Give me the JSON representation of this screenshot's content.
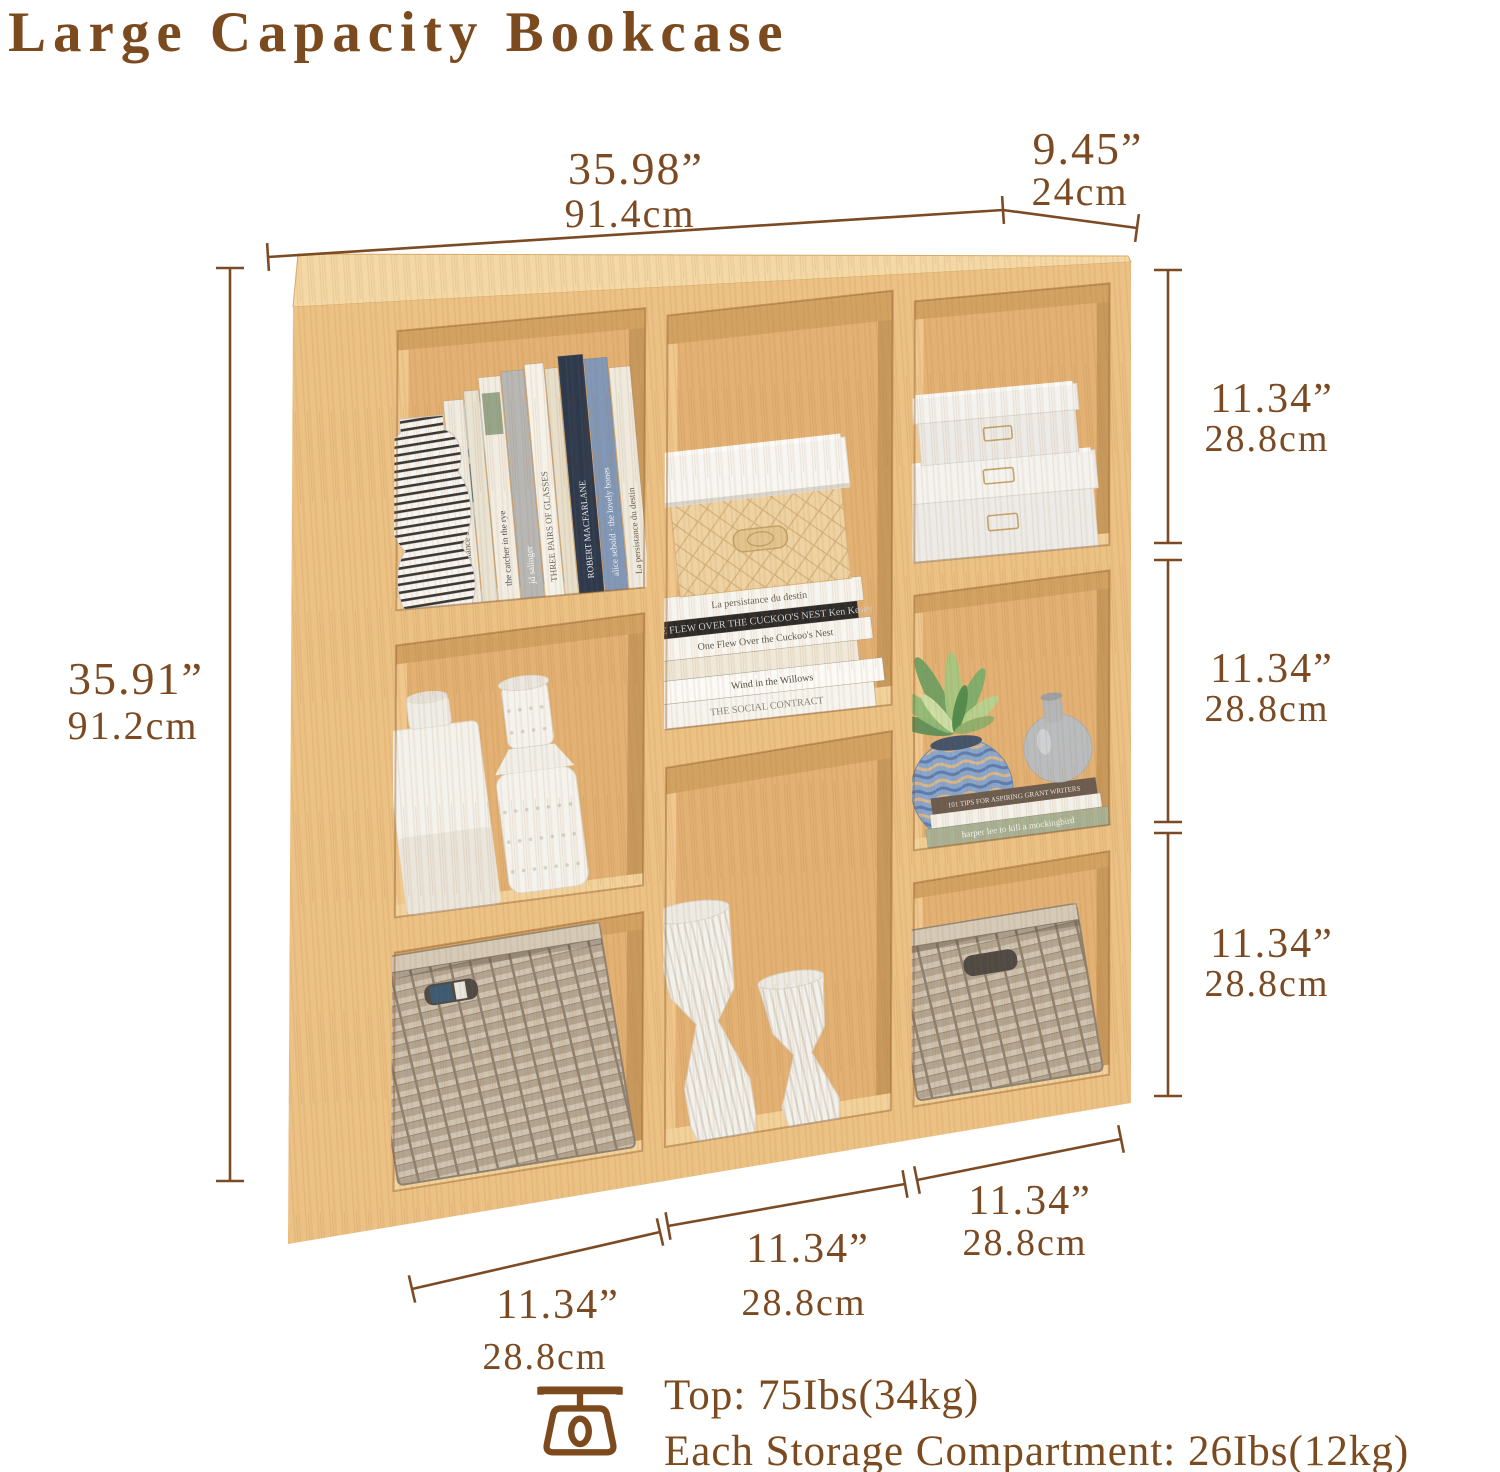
{
  "title": "Large Capacity Bookcase",
  "colors": {
    "accent_brown": "#7b4a1e",
    "dim_line": "#7c4b24",
    "wood_front": "#ecc184",
    "wood_top": "#f4d9a6",
    "wood_interior": "#e2b173",
    "wood_interior_shadow": "#c8995d",
    "wood_interior_light": "#f0c78d",
    "wood_interior_top": "#d2a263",
    "wood_floor": "#f2d29a",
    "gold": "#c2a368"
  },
  "dims": {
    "width": {
      "in": "35.98”",
      "cm": "91.4cm"
    },
    "depth": {
      "in": "9.45”",
      "cm": "24cm"
    },
    "height": {
      "in": "35.91”",
      "cm": "91.2cm"
    },
    "right": [
      {
        "in": "11.34”",
        "cm": "28.8cm"
      },
      {
        "in": "11.34”",
        "cm": "28.8cm"
      },
      {
        "in": "11.34”",
        "cm": "28.8cm"
      }
    ],
    "bottom": [
      {
        "in": "11.34”",
        "cm": "28.8cm"
      },
      {
        "in": "11.34”",
        "cm": "28.8cm"
      },
      {
        "in": "11.34”",
        "cm": "28.8cm"
      }
    ]
  },
  "footer": {
    "icon": "scale-icon",
    "top_capacity": "Top: 75Ibs(34kg)",
    "compartment_capacity": "Each Storage Compartment: 26Ibs(12kg)"
  },
  "bookcase": {
    "cells": {
      "left_top": {
        "art_book": {
          "c": "#d9ddd3"
        },
        "books": [
          {
            "w": 20,
            "h": 204,
            "c": "#f0ece1",
            "title": "La persistance du destin",
            "tc": "#6b6353"
          },
          {
            "w": 15,
            "h": 212,
            "c": "#e9e3d3"
          },
          {
            "w": 22,
            "h": 224,
            "c": "#f2ede3",
            "title": "the catcher in the rye",
            "tc": "#53525e",
            "band": "#97a68b"
          },
          {
            "w": 23,
            "h": 228,
            "c": "#b7b7b5",
            "title": "jd salinger",
            "tc": "#ffffff"
          },
          {
            "w": 19,
            "h": 233,
            "c": "#f5f2ea",
            "title": "THREE PAIRS OF GLASSES",
            "tc": "#6d675b"
          },
          {
            "w": 13,
            "h": 227,
            "c": "#e7dfcb"
          },
          {
            "w": 25,
            "h": 238,
            "c": "#2d3a4e",
            "title": "ROBERT MACFARLANE",
            "tc": "#e8e8ea"
          },
          {
            "w": 23,
            "h": 233,
            "c": "#8198b8",
            "title": "alice sebold · the lovely bones",
            "tc": "#f2f4f7"
          },
          {
            "w": 21,
            "h": 222,
            "c": "#efeade",
            "title": "La persistance du destin",
            "tc": "#6b6353"
          }
        ],
        "vase": {
          "stripe_dark": "#3a3733",
          "stripe_light": "#f7f5f1"
        }
      },
      "middle_top": {
        "stack": [
          {
            "w": 218,
            "h": 25,
            "c": "#f6f4ee",
            "title": "THE SOCIAL CONTRACT",
            "tc": "#8a8478",
            "dx": -4
          },
          {
            "w": 224,
            "h": 23,
            "c": "#fbfaf6",
            "title": "Wind in the Willows",
            "tc": "#514c45",
            "dx": 4
          },
          {
            "w": 202,
            "h": 20,
            "c": "#f0e9da",
            "dx": -8
          },
          {
            "w": 214,
            "h": 22,
            "c": "#f8f6f0",
            "title": "One Flew Over the Cuckoo's Nest",
            "tc": "#5e594f",
            "dx": 2
          },
          {
            "w": 198,
            "h": 17,
            "c": "#2a2a2a",
            "title": "ONE FLEW OVER THE CUCKOO'S NEST  Ken Kesey",
            "tc": "#cfcfcf",
            "dx": -2
          },
          {
            "w": 208,
            "h": 24,
            "c": "#f7f5ef",
            "title": "La persistance du destin",
            "tc": "#6b6353",
            "dx": 0
          }
        ],
        "box": {
          "base": "#eed2a2",
          "lid": "#f7f6f2",
          "plate": "#e3c48e"
        }
      },
      "right_top": {
        "box_color": "#edebe7",
        "lid_color": "#f4f3ef"
      },
      "left_middle": {
        "vase_white": "#f4f2ec",
        "vase_dotted": "#f5f3ee"
      },
      "right_middle": {
        "stack": [
          {
            "w": 184,
            "h": 19,
            "c": "#a9b295",
            "title": "harper lee   to kill a mockingbird",
            "tc": "#f4f4ee",
            "fs": 9
          },
          {
            "w": 172,
            "h": 14,
            "c": "#f3f1ea"
          },
          {
            "w": 166,
            "h": 16,
            "c": "#6b5c50",
            "title": "101 TIPS FOR ASPIRING GRANT WRITERS",
            "tc": "#e9e6df",
            "fs": 7
          }
        ],
        "pot": {
          "base": "#8aa6cc",
          "wave1": "#d7b88c",
          "wave2": "#5c7db0"
        },
        "gourd_vase": "#babdbf",
        "leaves": [
          [
            -72,
            62,
            16,
            "#5d8f57"
          ],
          [
            -48,
            74,
            18,
            "#8fbc77"
          ],
          [
            -20,
            84,
            18,
            "#6f9f63"
          ],
          [
            5,
            80,
            17,
            "#a4c77f"
          ],
          [
            32,
            70,
            16,
            "#7bae6b"
          ],
          [
            58,
            56,
            15,
            "#b5d38f"
          ],
          [
            -34,
            50,
            12,
            "#cfe0a8"
          ],
          [
            20,
            48,
            12,
            "#4f8a4c"
          ],
          [
            78,
            42,
            12,
            "#8fae6b"
          ]
        ]
      },
      "middle_bottom": {
        "vase_fill": "#f3f1eb"
      },
      "left_bottom": {
        "basket": {
          "base": "#c6b9a6",
          "rim": "#d5c9b7",
          "dark": "#4f4a43",
          "edge": "#8e8170"
        },
        "tag": "#3c5a74"
      },
      "right_bottom": {
        "basket": {
          "base": "#c6b9a6",
          "rim": "#d5c9b7",
          "dark": "#4f4a43",
          "edge": "#8e8170"
        }
      }
    }
  }
}
